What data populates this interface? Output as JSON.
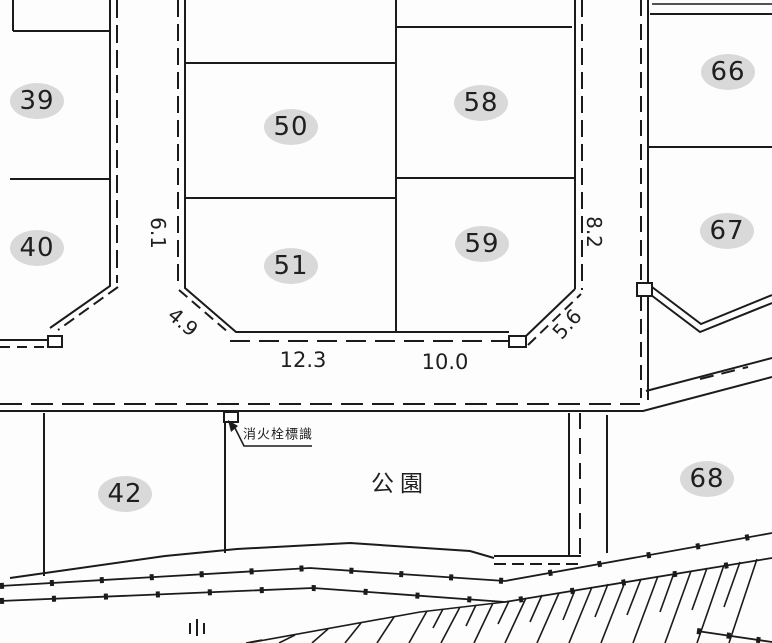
{
  "map": {
    "kind": "cadastral-parcel-map",
    "colors": {
      "line": "#1b1b1b",
      "background": "#fdfdfd",
      "badge": "#d9d9d9",
      "text": "#1f1f1f"
    },
    "parcels": [
      {
        "label": "39",
        "x": 37,
        "y": 101
      },
      {
        "label": "40",
        "x": 37,
        "y": 248
      },
      {
        "label": "50",
        "x": 291,
        "y": 127
      },
      {
        "label": "51",
        "x": 291,
        "y": 266
      },
      {
        "label": "58",
        "x": 481,
        "y": 103
      },
      {
        "label": "59",
        "x": 482,
        "y": 244
      },
      {
        "label": "66",
        "x": 728,
        "y": 72
      },
      {
        "label": "67",
        "x": 727,
        "y": 231
      },
      {
        "label": "42",
        "x": 125,
        "y": 494
      },
      {
        "label": "68",
        "x": 707,
        "y": 479
      }
    ],
    "dimensions": [
      {
        "value": "6.1",
        "x": 158,
        "y": 233,
        "rotate": 90,
        "size": 20
      },
      {
        "value": "8.2",
        "x": 594,
        "y": 232,
        "rotate": 90,
        "size": 20
      },
      {
        "value": "4.9",
        "x": 183,
        "y": 322,
        "rotate": 40,
        "size": 20
      },
      {
        "value": "5.6",
        "x": 567,
        "y": 324,
        "rotate": -48,
        "size": 20
      },
      {
        "value": "12.3",
        "x": 303,
        "y": 360,
        "rotate": 0,
        "size": 21
      },
      {
        "value": "10.0",
        "x": 445,
        "y": 362,
        "rotate": 0,
        "size": 21
      }
    ],
    "annotations": [
      {
        "id": "park-label",
        "text": "公園",
        "x": 400,
        "y": 481,
        "size": 23,
        "spacing": 6
      },
      {
        "id": "fire-hydrant-sign-label",
        "text": "消火栓標識",
        "x": 278,
        "y": 433,
        "size": 13,
        "spacing": 1
      }
    ]
  }
}
